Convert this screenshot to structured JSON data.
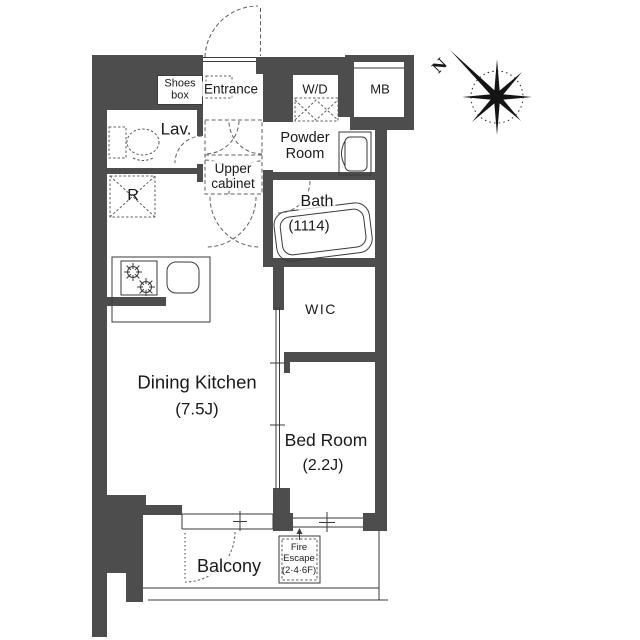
{
  "plan": {
    "labels": {
      "shoes_box": "Shoes\nbox",
      "entrance": "Entrance",
      "wd": "W/D",
      "mb": "MB",
      "lav": "Lav.",
      "powder_room": "Powder\nRoom",
      "upper_cabinet": "Upper\ncabinet",
      "bath": "Bath",
      "bath_size": "(1114)",
      "refrigerator": "R",
      "wic": "WIC",
      "dining_kitchen": "Dining Kitchen",
      "dining_kitchen_size": "(7.5J)",
      "bed_room": "Bed Room",
      "bed_room_size": "(2.2J)",
      "balcony": "Balcony",
      "fire_escape": "Fire\nEscape\n(2·4·6F)",
      "compass_north": "N"
    },
    "colors": {
      "wall": "#4d4d4d",
      "line": "#3a3a3a",
      "dashline": "#5f5f5f",
      "text": "#1a1a1a",
      "bg": "#ffffff"
    }
  }
}
